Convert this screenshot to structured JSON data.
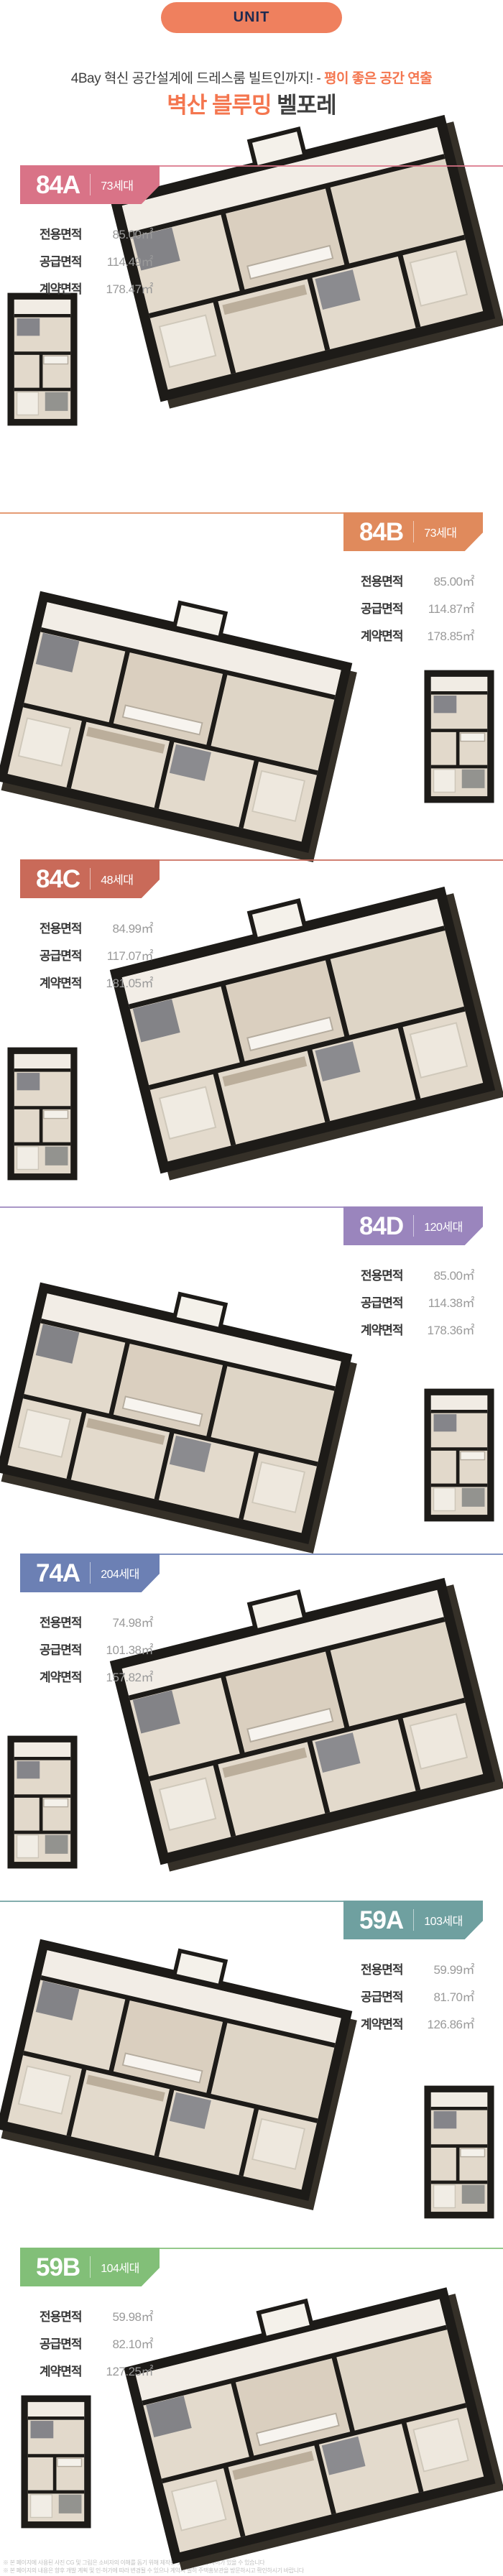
{
  "header": {
    "unit_label": "UNIT",
    "headline_normal": "4Bay 혁신 공간설계에 드레스룸 빌트인까지! - ",
    "headline_accent": "평이 좋은 공간 연출",
    "title_accent": "벽산 블루밍",
    "title_normal": " 벨포레",
    "accent_color": "#f4764f",
    "pill_color": "#ef805e",
    "pill_text_color": "#1f2a50"
  },
  "units": [
    {
      "code": "84A",
      "households": "73세대",
      "color": "#d97387",
      "side": "left",
      "specs": [
        {
          "label": "전용면적",
          "value": "85.00㎡"
        },
        {
          "label": "공급면적",
          "value": "114.49㎡"
        },
        {
          "label": "계약면적",
          "value": "178.47㎡"
        }
      ]
    },
    {
      "code": "84B",
      "households": "73세대",
      "color": "#e08a5c",
      "side": "right",
      "specs": [
        {
          "label": "전용면적",
          "value": "85.00㎡"
        },
        {
          "label": "공급면적",
          "value": "114.87㎡"
        },
        {
          "label": "계약면적",
          "value": "178.85㎡"
        }
      ]
    },
    {
      "code": "84C",
      "households": "48세대",
      "color": "#c96a59",
      "side": "left",
      "specs": [
        {
          "label": "전용면적",
          "value": "84.99㎡"
        },
        {
          "label": "공급면적",
          "value": "117.07㎡"
        },
        {
          "label": "계약면적",
          "value": "181.05㎡"
        }
      ]
    },
    {
      "code": "84D",
      "households": "120세대",
      "color": "#9a85bd",
      "side": "right",
      "specs": [
        {
          "label": "전용면적",
          "value": "85.00㎡"
        },
        {
          "label": "공급면적",
          "value": "114.38㎡"
        },
        {
          "label": "계약면적",
          "value": "178.36㎡"
        }
      ]
    },
    {
      "code": "74A",
      "households": "204세대",
      "color": "#6c80b4",
      "side": "left",
      "specs": [
        {
          "label": "전용면적",
          "value": "74.98㎡"
        },
        {
          "label": "공급면적",
          "value": "101.38㎡"
        },
        {
          "label": "계약면적",
          "value": "157.82㎡"
        }
      ]
    },
    {
      "code": "59A",
      "households": "103세대",
      "color": "#6fa0a0",
      "side": "right",
      "specs": [
        {
          "label": "전용면적",
          "value": "59.99㎡"
        },
        {
          "label": "공급면적",
          "value": "81.70㎡"
        },
        {
          "label": "계약면적",
          "value": "126.86㎡"
        }
      ]
    },
    {
      "code": "59B",
      "households": "104세대",
      "color": "#82bf78",
      "side": "left",
      "specs": [
        {
          "label": "전용면적",
          "value": "59.98㎡"
        },
        {
          "label": "공급면적",
          "value": "82.10㎡"
        },
        {
          "label": "계약면적",
          "value": "127.25㎡"
        }
      ]
    }
  ],
  "footer": {
    "disclaimer_line1": "※ 본 페이지에 사용된 사진 CG 및 그림은 소비자의 이해를 돕기 위해 제작된 것으로 실제와 차이가 있을 수 있습니다",
    "disclaimer_line2": "※ 본 페이지의 내용은 향후 개발 계획 및 인·허가에 따라 변경될 수 있으나 계약시 필히 주택홍보관을 방문하시고 확인하시기 바랍니다"
  }
}
